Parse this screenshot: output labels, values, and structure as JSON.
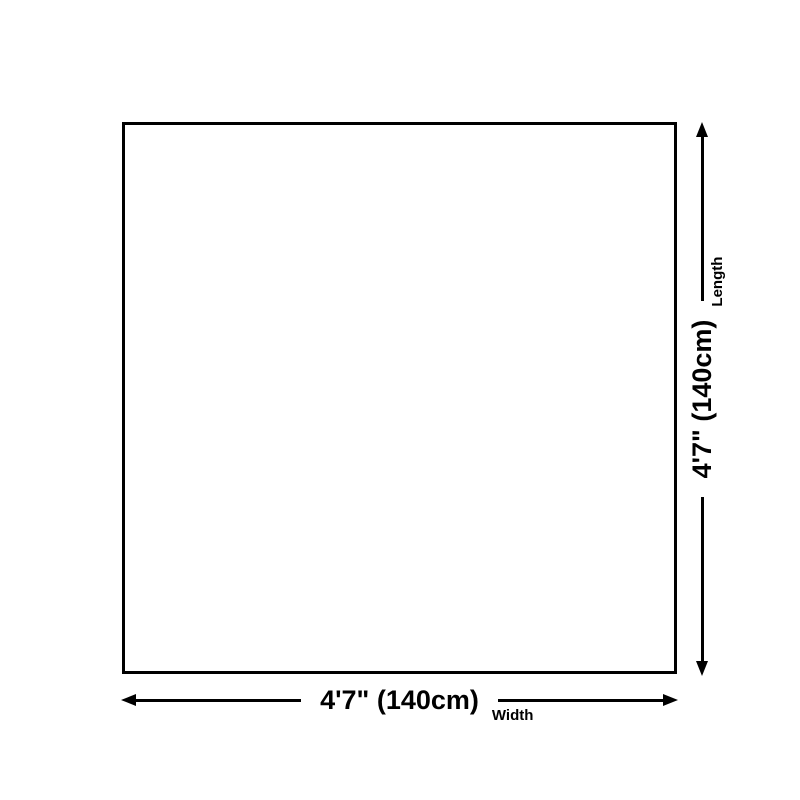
{
  "diagram": {
    "background_color": "#ffffff",
    "line_color": "#000000",
    "width_dimension": {
      "value": "4'7\" (140cm)",
      "label": "Width"
    },
    "length_dimension": {
      "value": "4'7\" (140cm)",
      "label": "Length"
    },
    "icons": {
      "bottom_left": "arrow-left-icon",
      "bottom_right": "arrow-right-icon",
      "side_bottom": "arrow-down-icon",
      "side_top": "arrow-up-icon"
    }
  }
}
